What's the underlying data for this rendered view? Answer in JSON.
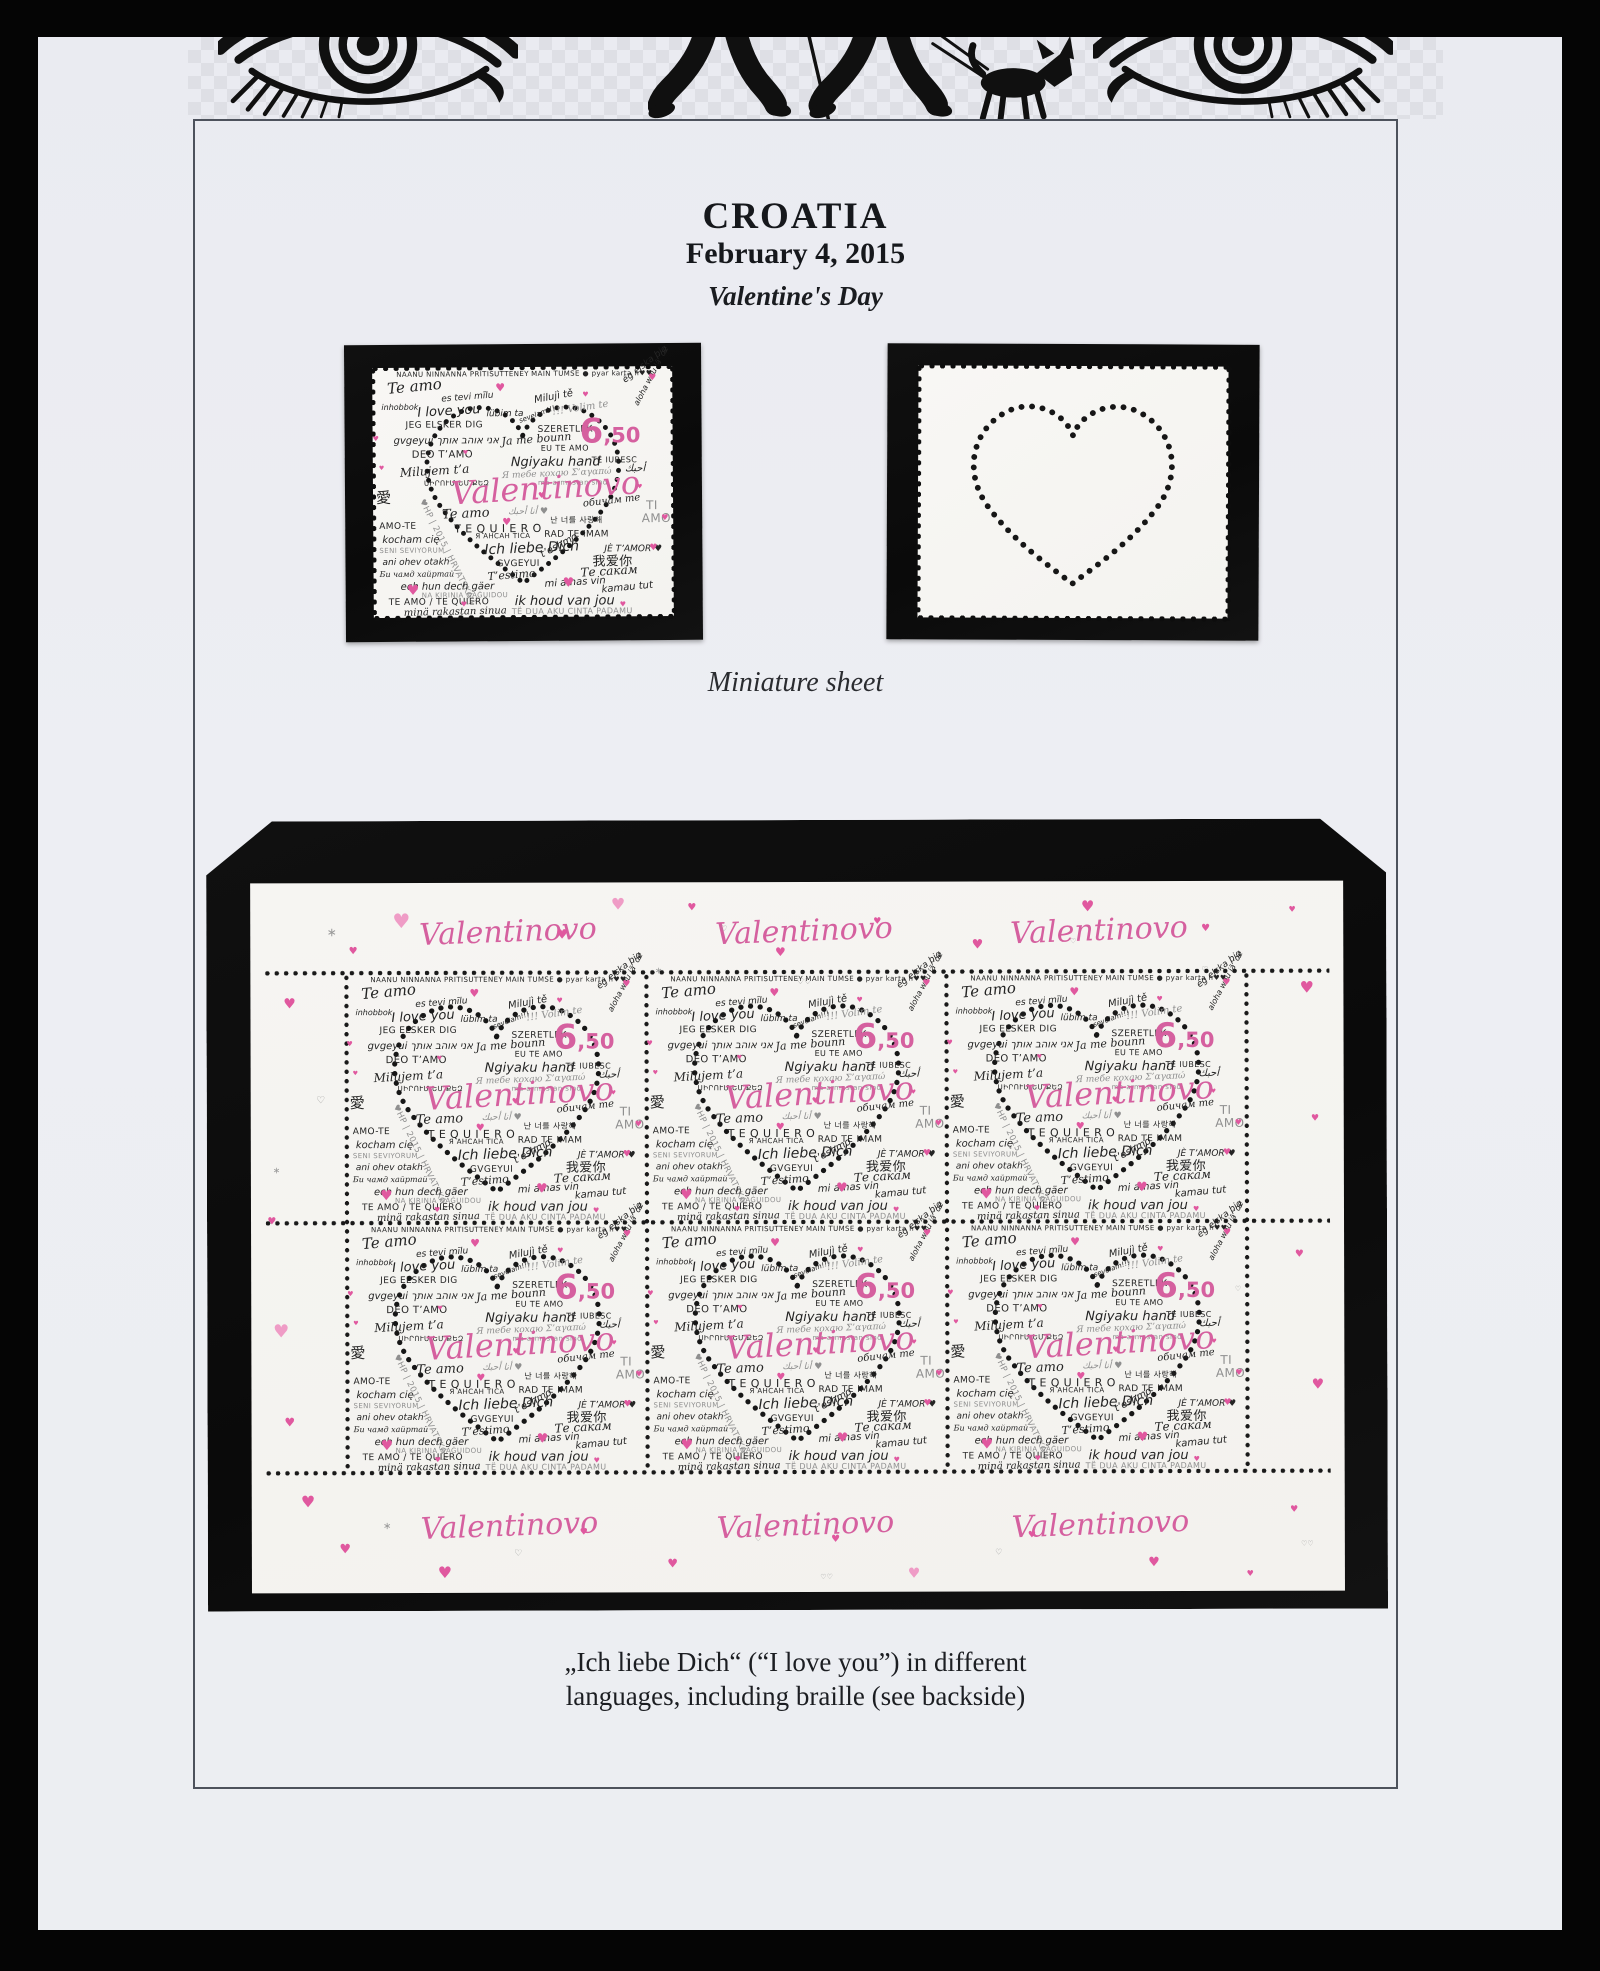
{
  "page": {
    "title": "CROATIA",
    "date": "February 4, 2015",
    "subtitle": "Valentine's Day",
    "miniature_label": "Miniature sheet",
    "caption_line1": "„Ich liebe Dich“ (“I love you”) in different",
    "caption_line2": "languages, including braille (see backside)",
    "colors": {
      "pink": "#d5609f",
      "pink_light": "#ef9cc6",
      "ink": "#242424",
      "gray": "#8f8f8f",
      "mount": "#0d0d0d"
    }
  },
  "stamp": {
    "denomination": "6,50",
    "title_script": "Valentinovo",
    "country_mark": "♥HP | 2015 | HRVATSKA |",
    "phrases": [
      {
        "t": "NAANU NINNANNA PRITISUTTENEY",
        "x": 8,
        "y": 1.4,
        "s": 7,
        "r": 0,
        "c": "k",
        "f": "c"
      },
      {
        "t": "MAIN TUMSE ● pyar karta h♥♥",
        "x": 53,
        "y": 1.4,
        "s": 7,
        "r": 0,
        "c": "k",
        "f": "c"
      },
      {
        "t": "Te amo",
        "x": 5,
        "y": 5.5,
        "s": 15,
        "r": -5,
        "c": "k",
        "f": "s"
      },
      {
        "t": "ég elska þig",
        "x": 84,
        "y": 4.5,
        "s": 9,
        "r": -38,
        "c": "k",
        "f": "h"
      },
      {
        "t": "inhobbok",
        "x": 3,
        "y": 14.5,
        "s": 8,
        "r": 0,
        "c": "k",
        "f": "h"
      },
      {
        "t": "es tevi mīlu",
        "x": 23,
        "y": 11,
        "s": 9,
        "r": -4,
        "c": "k",
        "f": "h"
      },
      {
        "t": "I love you",
        "x": 15,
        "y": 15.5,
        "s": 13,
        "r": -3,
        "c": "k",
        "f": "h"
      },
      {
        "t": "lübim ta",
        "x": 38,
        "y": 17,
        "s": 9,
        "r": 0,
        "c": "k",
        "f": "h"
      },
      {
        "t": "Milujì tě",
        "x": 54,
        "y": 11.5,
        "s": 10,
        "r": -10,
        "c": "k",
        "f": "h"
      },
      {
        "t": "!!! Volim te",
        "x": 60,
        "y": 16.5,
        "s": 10,
        "r": -8,
        "c": "g",
        "f": "s"
      },
      {
        "t": "JEG ELSKER DIG",
        "x": 11,
        "y": 21.5,
        "s": 9,
        "r": 0,
        "c": "k",
        "f": "c"
      },
      {
        "t": "sevelam!!!",
        "x": 49,
        "y": 20.5,
        "s": 7,
        "r": -20,
        "c": "k",
        "f": "h"
      },
      {
        "t": "SZERETLEK",
        "x": 55,
        "y": 23.5,
        "s": 9,
        "r": 0,
        "c": "k",
        "f": "c"
      },
      {
        "t": "gvgeyui אני אוהב אותך",
        "x": 7,
        "y": 27.5,
        "s": 10,
        "r": 0,
        "c": "k",
        "f": "h"
      },
      {
        "t": "Ja me bounn",
        "x": 43,
        "y": 27.5,
        "s": 11,
        "r": -4,
        "c": "k",
        "f": "s"
      },
      {
        "t": "EU TE AMO",
        "x": 56,
        "y": 31,
        "s": 8,
        "r": 0,
        "c": "k",
        "f": "c"
      },
      {
        "t": "aloha wau iā ʻoe",
        "x": 88,
        "y": 14,
        "s": 8,
        "r": -62,
        "c": "k",
        "f": "h"
      },
      {
        "t": "DEO T’AMO",
        "x": 13,
        "y": 33,
        "s": 10,
        "r": 0,
        "c": "k",
        "f": "c"
      },
      {
        "t": "Ngiyaku hand",
        "x": 46,
        "y": 35.5,
        "s": 13,
        "r": 0,
        "c": "k",
        "f": "h"
      },
      {
        "t": "TE IUBESC",
        "x": 73,
        "y": 36,
        "s": 8,
        "r": 0,
        "c": "k",
        "f": "c"
      },
      {
        "t": "Milujem t’a",
        "x": 9,
        "y": 39.5,
        "s": 12,
        "r": -3,
        "c": "k",
        "f": "s"
      },
      {
        "t": "Я тебе кохаю  Σ’αγαπώ",
        "x": 43,
        "y": 42,
        "s": 9,
        "r": -2,
        "c": "g",
        "f": "s"
      },
      {
        "t": "أحبك",
        "x": 84,
        "y": 39,
        "s": 10,
        "r": 0,
        "c": "k",
        "f": "h"
      },
      {
        "t": "ma armastan sind",
        "x": 55,
        "y": 45,
        "s": 7,
        "r": 0,
        "c": "g",
        "f": "c"
      },
      {
        "t": "ՍԻՐՈՒՄ ԵՄ ՔԵԶ",
        "x": 17,
        "y": 45,
        "s": 7,
        "r": 0,
        "c": "k",
        "f": "c"
      },
      {
        "t": "愛",
        "x": 1,
        "y": 49,
        "s": 15,
        "r": 0,
        "c": "k",
        "f": "c"
      },
      {
        "t": "♥HP | 2015 | HRVATSKA |",
        "x": 16,
        "y": 51,
        "s": 8.5,
        "r": 64,
        "c": "g",
        "f": "c"
      },
      {
        "t": "обичам те",
        "x": 70,
        "y": 53,
        "s": 10,
        "r": -6,
        "c": "k",
        "f": "s"
      },
      {
        "t": "Te amo",
        "x": 23,
        "y": 56.5,
        "s": 13,
        "r": -2,
        "c": "k",
        "f": "s"
      },
      {
        "t": "أنا أحبك ♥",
        "x": 45,
        "y": 56.5,
        "s": 9,
        "r": 0,
        "c": "g",
        "f": "h"
      },
      {
        "t": "TI",
        "x": 91,
        "y": 53,
        "s": 12,
        "r": 0,
        "c": "g",
        "f": "c"
      },
      {
        "t": "AMO",
        "x": 89.5,
        "y": 58.5,
        "s": 12,
        "r": 0,
        "c": "g",
        "f": "c"
      },
      {
        "t": "T E  Q U I E R O",
        "x": 27,
        "y": 62.5,
        "s": 11,
        "r": 0,
        "c": "k",
        "f": "c"
      },
      {
        "t": "난 너를 사랑해",
        "x": 59,
        "y": 60,
        "s": 8,
        "r": 0,
        "c": "k",
        "f": "c"
      },
      {
        "t": "Я АНСАН ТІСА",
        "x": 34,
        "y": 66.5,
        "s": 7,
        "r": 0,
        "c": "k",
        "f": "c"
      },
      {
        "t": "RAD TE IMAM",
        "x": 57,
        "y": 65.5,
        "s": 9,
        "r": 0,
        "c": "k",
        "f": "c"
      },
      {
        "t": "AMO-TE",
        "x": 2,
        "y": 62,
        "s": 9,
        "r": 0,
        "c": "k",
        "f": "c"
      },
      {
        "t": "kocham cię",
        "x": 3,
        "y": 67,
        "s": 10,
        "r": 0,
        "c": "k",
        "f": "h"
      },
      {
        "t": "SENI SEVIYORUM",
        "x": 2,
        "y": 72,
        "s": 7,
        "r": 0,
        "c": "g",
        "f": "c"
      },
      {
        "t": "ani ohev otakh",
        "x": 3,
        "y": 76.5,
        "s": 9,
        "r": 0,
        "c": "k",
        "f": "h"
      },
      {
        "t": "Ich liebe Dich",
        "x": 37,
        "y": 70.5,
        "s": 14,
        "r": -2,
        "c": "k",
        "f": "h"
      },
      {
        "t": "GVGEYUI",
        "x": 41,
        "y": 77,
        "s": 9,
        "r": 0,
        "c": "k",
        "f": "c"
      },
      {
        "t": "t’eshmo",
        "x": 56,
        "y": 73.5,
        "s": 10,
        "r": -28,
        "c": "k",
        "f": "h"
      },
      {
        "t": "JÈ T’AMOR ♥",
        "x": 77,
        "y": 71.5,
        "s": 9,
        "r": 0,
        "c": "k",
        "f": "h"
      },
      {
        "t": "我爱你",
        "x": 73,
        "y": 75.5,
        "s": 13,
        "r": 0,
        "c": "k",
        "f": "c"
      },
      {
        "t": "Те сакам",
        "x": 69,
        "y": 80,
        "s": 12,
        "r": -3,
        "c": "k",
        "f": "s"
      },
      {
        "t": "Би чамд хайртай",
        "x": 2,
        "y": 81,
        "s": 8,
        "r": 0,
        "c": "k",
        "f": "s"
      },
      {
        "t": "T’estimo",
        "x": 38,
        "y": 81.5,
        "s": 11,
        "r": -4,
        "c": "k",
        "f": "s"
      },
      {
        "t": "ech hun dech gäer",
        "x": 9,
        "y": 86,
        "s": 10,
        "r": 0,
        "c": "k",
        "f": "h"
      },
      {
        "t": "mi amas vin",
        "x": 57,
        "y": 85,
        "s": 10,
        "r": -3,
        "c": "k",
        "f": "h"
      },
      {
        "t": "NA KIRINIA GAĠUIDOU",
        "x": 16,
        "y": 90,
        "s": 7,
        "r": 0,
        "c": "g",
        "f": "c"
      },
      {
        "t": "kamau tut",
        "x": 76,
        "y": 87.5,
        "s": 10,
        "r": -5,
        "c": "k",
        "f": "h"
      },
      {
        "t": "TE AMO / TE QUIERO",
        "x": 5,
        "y": 92.5,
        "s": 9,
        "r": 0,
        "c": "k",
        "f": "c"
      },
      {
        "t": "ik houd van jou",
        "x": 47,
        "y": 91,
        "s": 13,
        "r": 0,
        "c": "k",
        "f": "h"
      },
      {
        "t": "minä rakastan sinua",
        "x": 10,
        "y": 96.5,
        "s": 10,
        "r": -1,
        "c": "k",
        "f": "s"
      },
      {
        "t": "TË DUA  AKU CINTA PADAMU",
        "x": 46,
        "y": 96.5,
        "s": 8,
        "r": 0,
        "c": "g",
        "f": "c"
      }
    ],
    "valentinovo": {
      "x": 26,
      "y": 44,
      "s": 32,
      "r": -3
    },
    "denom_pos": {
      "x": 69,
      "y": 19
    },
    "hearts": [
      {
        "x": 41,
        "y": 6,
        "s": 11
      },
      {
        "x": 70,
        "y": 10,
        "s": 7
      },
      {
        "x": 92,
        "y": 3,
        "s": 9
      },
      {
        "x": 0,
        "y": 27,
        "s": 7
      },
      {
        "x": 55,
        "y": 50,
        "s": 8
      },
      {
        "x": 43,
        "y": 60.5,
        "s": 10
      },
      {
        "x": 30,
        "y": 33,
        "s": 6
      },
      {
        "x": 63,
        "y": 84,
        "s": 13
      },
      {
        "x": 11,
        "y": 86.5,
        "s": 14
      },
      {
        "x": 92,
        "y": 71,
        "s": 9
      },
      {
        "x": 82,
        "y": 94,
        "s": 7
      },
      {
        "x": 29,
        "y": 93.5,
        "s": 7
      },
      {
        "x": 96,
        "y": 59,
        "s": 8
      },
      {
        "x": 2,
        "y": 39,
        "s": 6
      },
      {
        "x": 88,
        "y": 47,
        "s": 6
      }
    ]
  },
  "sheet": {
    "script_label": "Valentinovo",
    "label_columns_pct": [
      24,
      51,
      78
    ],
    "hearts": [
      {
        "x": 3,
        "y": 16,
        "s": 14
      },
      {
        "x": 1.5,
        "y": 47,
        "s": 10
      },
      {
        "x": 2,
        "y": 62,
        "s": 18,
        "lt": 1
      },
      {
        "x": 3,
        "y": 75,
        "s": 12
      },
      {
        "x": 4.5,
        "y": 86,
        "s": 16
      },
      {
        "x": 13,
        "y": 4,
        "s": 20,
        "lt": 1
      },
      {
        "x": 9,
        "y": 9,
        "s": 10
      },
      {
        "x": 28,
        "y": 6.5,
        "s": 13
      },
      {
        "x": 40,
        "y": 3,
        "s": 10
      },
      {
        "x": 48,
        "y": 9,
        "s": 12
      },
      {
        "x": 57,
        "y": 5,
        "s": 9
      },
      {
        "x": 66,
        "y": 8,
        "s": 13
      },
      {
        "x": 76,
        "y": 2.5,
        "s": 15
      },
      {
        "x": 87,
        "y": 6,
        "s": 10
      },
      {
        "x": 95,
        "y": 3.5,
        "s": 8
      },
      {
        "x": 96,
        "y": 14,
        "s": 16
      },
      {
        "x": 97,
        "y": 33,
        "s": 9
      },
      {
        "x": 95.5,
        "y": 52,
        "s": 10
      },
      {
        "x": 97,
        "y": 70,
        "s": 14
      },
      {
        "x": 95,
        "y": 88,
        "s": 9
      },
      {
        "x": 8,
        "y": 93,
        "s": 13
      },
      {
        "x": 17,
        "y": 96,
        "s": 16
      },
      {
        "x": 30,
        "y": 91,
        "s": 9
      },
      {
        "x": 38,
        "y": 95,
        "s": 12
      },
      {
        "x": 53,
        "y": 92,
        "s": 10
      },
      {
        "x": 60,
        "y": 96.5,
        "s": 14,
        "lt": 1
      },
      {
        "x": 71,
        "y": 91.5,
        "s": 9
      },
      {
        "x": 82,
        "y": 95,
        "s": 13
      },
      {
        "x": 91,
        "y": 97,
        "s": 8
      },
      {
        "x": 33,
        "y": 2,
        "s": 16,
        "lt": 1
      }
    ],
    "doodles": [
      {
        "t": "♡",
        "x": 6,
        "y": 30,
        "s": 10
      },
      {
        "t": "♡♡",
        "x": 50,
        "y": 13.5,
        "s": 8
      },
      {
        "t": "♡",
        "x": 43,
        "y": 6,
        "s": 8
      },
      {
        "t": "∗",
        "x": 7,
        "y": 6,
        "s": 12
      },
      {
        "t": "∗",
        "x": 37,
        "y": 12,
        "s": 9
      },
      {
        "t": "♡",
        "x": 87,
        "y": 12,
        "s": 8
      },
      {
        "t": "♡",
        "x": 75,
        "y": 8,
        "s": 7
      },
      {
        "t": "♡",
        "x": 24,
        "y": 94,
        "s": 9
      },
      {
        "t": "♡♡",
        "x": 96,
        "y": 93,
        "s": 7
      },
      {
        "t": "♡",
        "x": 46,
        "y": 92,
        "s": 8
      },
      {
        "t": "∗",
        "x": 12,
        "y": 90,
        "s": 10
      },
      {
        "t": "♡",
        "x": 68,
        "y": 94,
        "s": 8
      },
      {
        "t": "♡",
        "x": 90,
        "y": 57,
        "s": 7
      },
      {
        "t": "♡♡",
        "x": 52,
        "y": 97.5,
        "s": 7
      },
      {
        "t": "∗",
        "x": 2,
        "y": 40,
        "s": 9
      }
    ]
  }
}
